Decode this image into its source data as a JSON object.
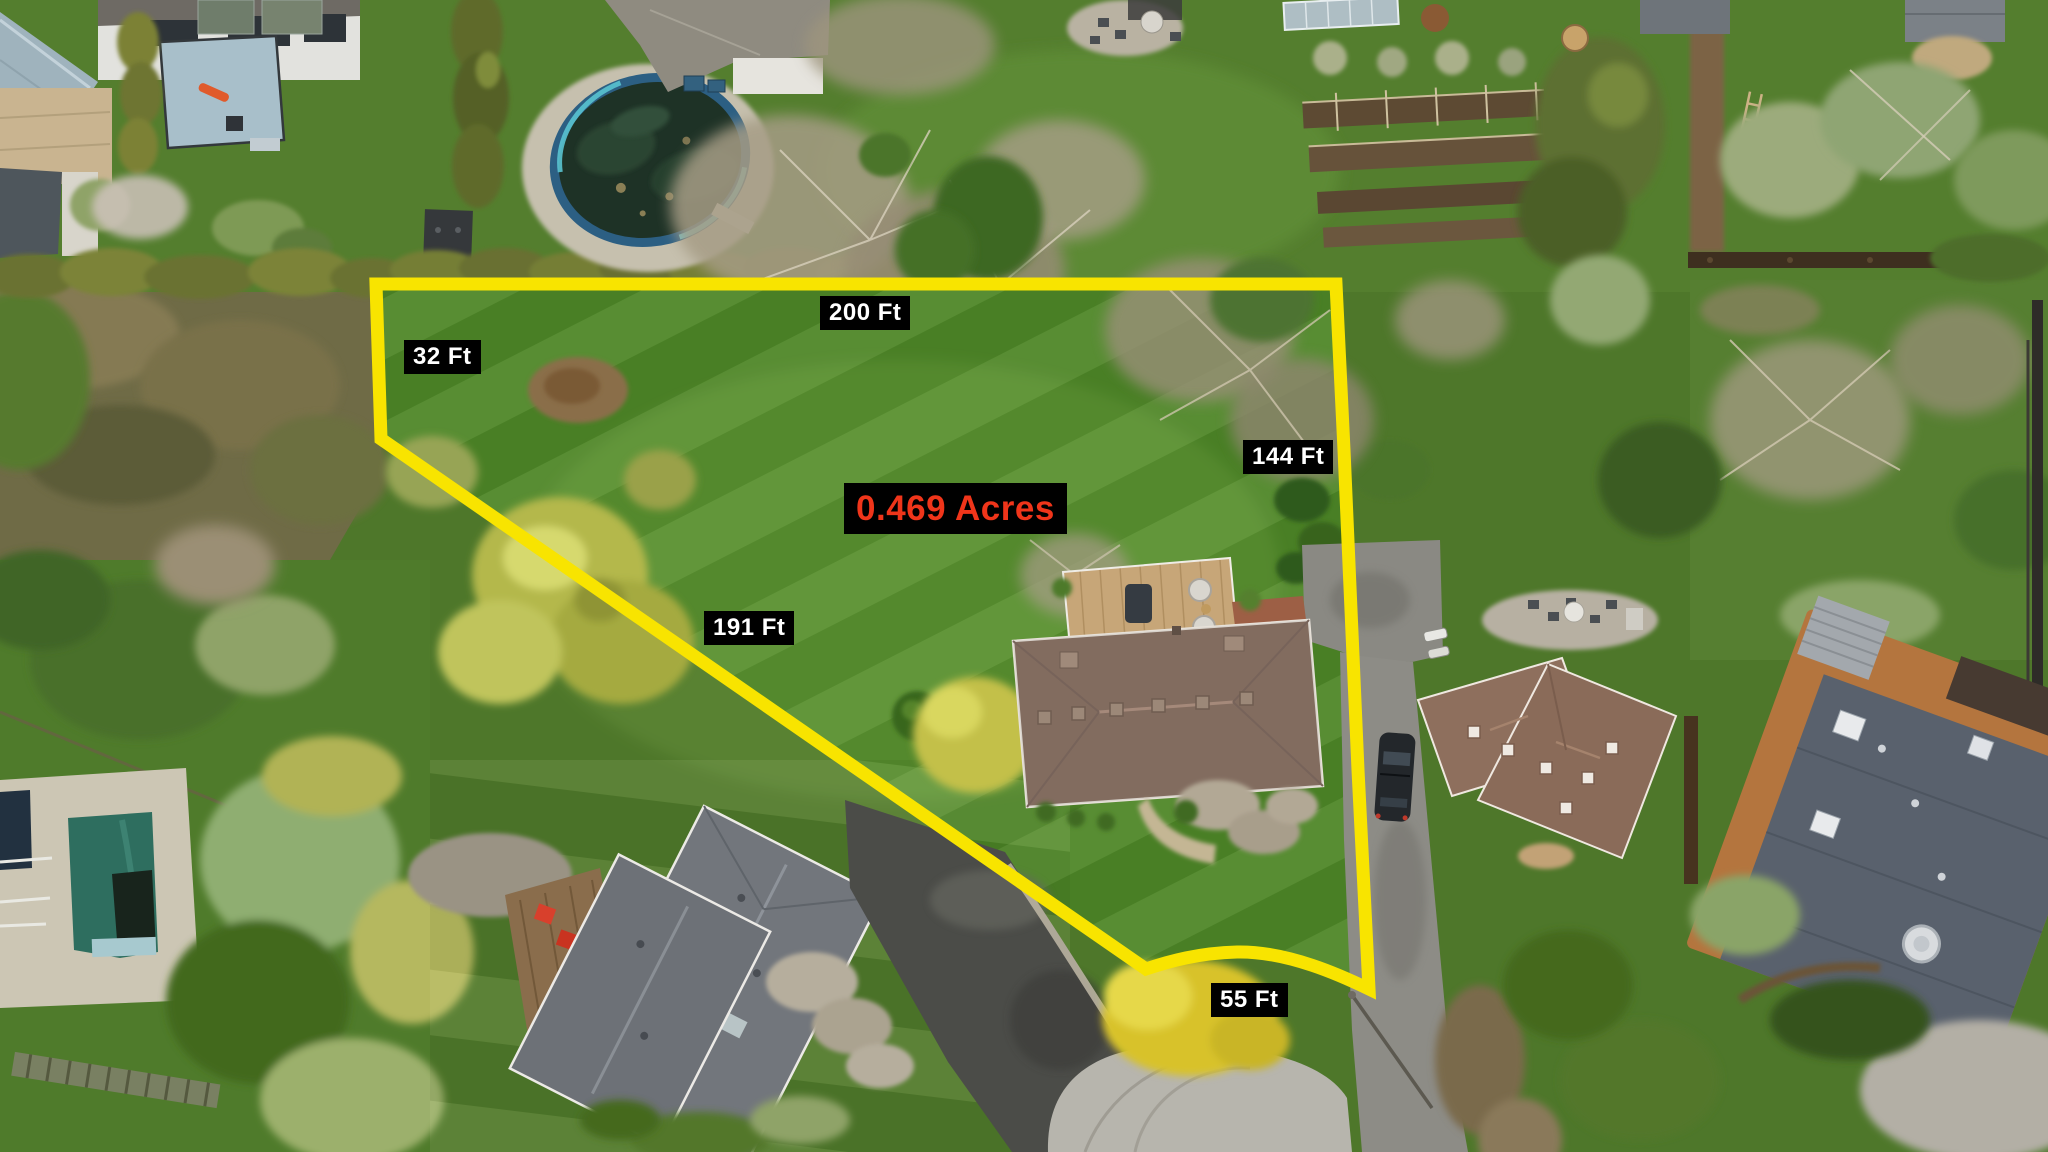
{
  "annotations": {
    "area_label": {
      "text": "0.469 Acres",
      "text_color": "#f0351a",
      "background": "#000000"
    },
    "dimensions": {
      "top": {
        "text": "200 Ft"
      },
      "left": {
        "text": "32 Ft"
      },
      "right": {
        "text": "144 Ft"
      },
      "diagonal": {
        "text": "191 Ft"
      },
      "bottom": {
        "text": "55 Ft"
      }
    },
    "label_style": {
      "background": "#000000",
      "text_color": "#ffffff"
    },
    "boundary": {
      "color": "#f8e400"
    }
  },
  "scene": {
    "type": "aerial-drone-photo-of-residential-lot",
    "features": [
      "outlined vacant side yard",
      "above-ground pool",
      "in-ground pool",
      "ranch house with deck",
      "neighbor houses",
      "driveways",
      "cul-de-sac",
      "garden beds",
      "lawns and trees"
    ]
  }
}
